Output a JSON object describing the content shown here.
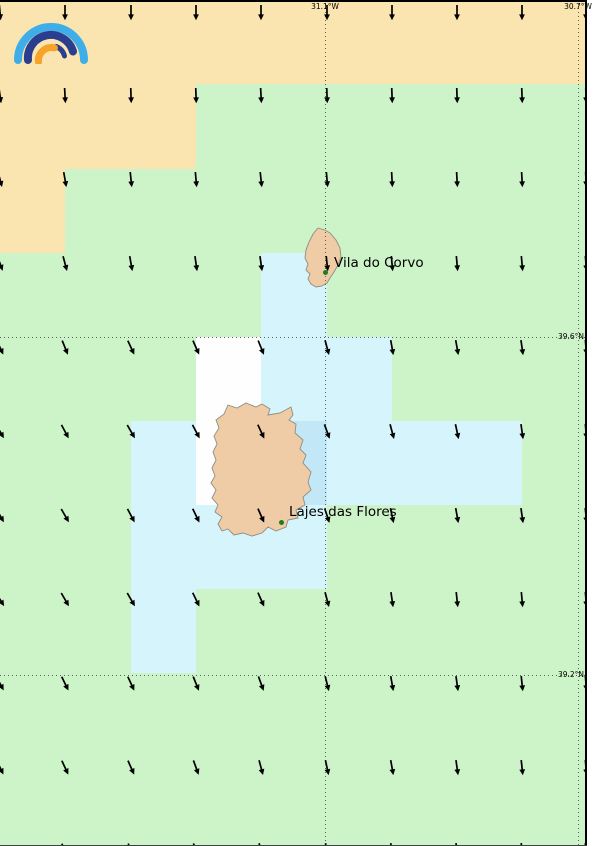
{
  "map": {
    "description_labels": {
      "place_1": "Vila do Corvo",
      "place_2": "Lajes das Flores"
    },
    "gridlines": {
      "meridians": [
        {
          "label": "31.1°W",
          "x": 325
        },
        {
          "label": "30.7°W",
          "x": 578
        }
      ],
      "parallels": [
        {
          "label": "39.6°N",
          "y": 337
        },
        {
          "label": "39.2°N",
          "y": 675
        }
      ]
    },
    "palette": {
      "O": "#FAE5B0",
      "G": "#CDF3C8",
      "C": "#D5F4FB",
      "B": "#C2E7F7",
      "W": "#FEFEFE"
    },
    "grid": {
      "col_edges": [
        0,
        65,
        131,
        196,
        261,
        327,
        392,
        457,
        522,
        587
      ],
      "row_edges": [
        0,
        84,
        169,
        253,
        337,
        421,
        505,
        589,
        673,
        757,
        846
      ],
      "cells": [
        "OOOOOOOOO",
        "OOOGGGGGG",
        "OGGGGGGGG",
        "GGGGCGGGG",
        "GGGWCCGGG",
        "GGCWBCCCG",
        "GGCCCGGGG",
        "GGCGGGGGG",
        "GGGGGGGGG",
        "GGGGGGGGG"
      ]
    },
    "arrows": {
      "color": "#000000",
      "cols": [
        0,
        65,
        131,
        196,
        261,
        327,
        392,
        457,
        522,
        586
      ],
      "rows": [
        4,
        87,
        171,
        255,
        339,
        423,
        507,
        591,
        675,
        759,
        842
      ],
      "tilt_deg_se": [
        [
          5,
          0,
          0,
          0,
          0,
          0,
          0,
          0,
          0,
          0
        ],
        [
          8,
          3,
          2,
          2,
          3,
          2,
          2,
          2,
          2,
          2
        ],
        [
          15,
          10,
          6,
          5,
          6,
          5,
          3,
          3,
          3,
          3
        ],
        [
          20,
          15,
          10,
          8,
          8,
          6,
          5,
          5,
          5,
          5
        ],
        [
          25,
          22,
          25,
          24,
          22,
          15,
          10,
          10,
          8,
          5
        ],
        [
          30,
          28,
          30,
          28,
          25,
          20,
          15,
          12,
          8,
          5
        ],
        [
          30,
          30,
          28,
          26,
          24,
          18,
          12,
          10,
          8,
          6
        ],
        [
          32,
          30,
          30,
          26,
          24,
          15,
          8,
          6,
          5,
          5
        ],
        [
          28,
          26,
          25,
          22,
          20,
          14,
          10,
          8,
          6,
          5
        ],
        [
          26,
          25,
          24,
          20,
          15,
          12,
          10,
          8,
          6,
          5
        ],
        [
          25,
          25,
          22,
          20,
          15,
          12,
          10,
          8,
          6,
          5
        ]
      ]
    },
    "islands": [
      {
        "name": "Corvo",
        "fill": "#EFCBA6",
        "stroke": "#8E8E80",
        "points": [
          [
            318,
            228
          ],
          [
            325,
            230
          ],
          [
            330,
            233
          ],
          [
            336,
            240
          ],
          [
            340,
            248
          ],
          [
            341,
            257
          ],
          [
            338,
            265
          ],
          [
            334,
            272
          ],
          [
            330,
            278
          ],
          [
            327,
            283
          ],
          [
            322,
            286
          ],
          [
            316,
            287
          ],
          [
            311,
            284
          ],
          [
            308,
            279
          ],
          [
            310,
            274
          ],
          [
            306,
            270
          ],
          [
            308,
            264
          ],
          [
            305,
            258
          ],
          [
            306,
            250
          ],
          [
            309,
            242
          ],
          [
            313,
            234
          ]
        ]
      },
      {
        "name": "Flores",
        "fill": "#EFCBA6",
        "stroke": "#8E8E80",
        "points": [
          [
            246,
            403
          ],
          [
            256,
            407
          ],
          [
            262,
            404
          ],
          [
            270,
            409
          ],
          [
            268,
            415
          ],
          [
            280,
            413
          ],
          [
            291,
            407
          ],
          [
            293,
            415
          ],
          [
            289,
            420
          ],
          [
            296,
            424
          ],
          [
            295,
            433
          ],
          [
            303,
            440
          ],
          [
            300,
            449
          ],
          [
            306,
            455
          ],
          [
            303,
            463
          ],
          [
            311,
            472
          ],
          [
            308,
            482
          ],
          [
            311,
            490
          ],
          [
            303,
            497
          ],
          [
            305,
            505
          ],
          [
            296,
            510
          ],
          [
            298,
            518
          ],
          [
            288,
            520
          ],
          [
            286,
            527
          ],
          [
            276,
            531
          ],
          [
            268,
            527
          ],
          [
            262,
            533
          ],
          [
            252,
            536
          ],
          [
            243,
            533
          ],
          [
            234,
            535
          ],
          [
            228,
            529
          ],
          [
            222,
            531
          ],
          [
            218,
            524
          ],
          [
            222,
            517
          ],
          [
            215,
            512
          ],
          [
            218,
            505
          ],
          [
            212,
            498
          ],
          [
            216,
            490
          ],
          [
            211,
            483
          ],
          [
            215,
            476
          ],
          [
            212,
            468
          ],
          [
            216,
            460
          ],
          [
            213,
            452
          ],
          [
            217,
            444
          ],
          [
            214,
            436
          ],
          [
            219,
            428
          ],
          [
            216,
            420
          ],
          [
            224,
            414
          ],
          [
            228,
            405
          ],
          [
            237,
            408
          ]
        ]
      }
    ],
    "places": [
      {
        "name": "Vila do Corvo",
        "dot_x": 325,
        "dot_y": 272,
        "dot_color": "#1E7D1E",
        "label_left": 334,
        "label_top": 255
      },
      {
        "name": "Lajes das Flores",
        "dot_x": 281,
        "dot_y": 522,
        "dot_color": "#1E7D1E",
        "label_left": 289,
        "label_top": 504
      }
    ],
    "logo": {
      "outer_arc_color": "#3FAEE8",
      "middle_arc_color": "#2B3D8F",
      "inner_arc_color": "#F7A329"
    }
  }
}
